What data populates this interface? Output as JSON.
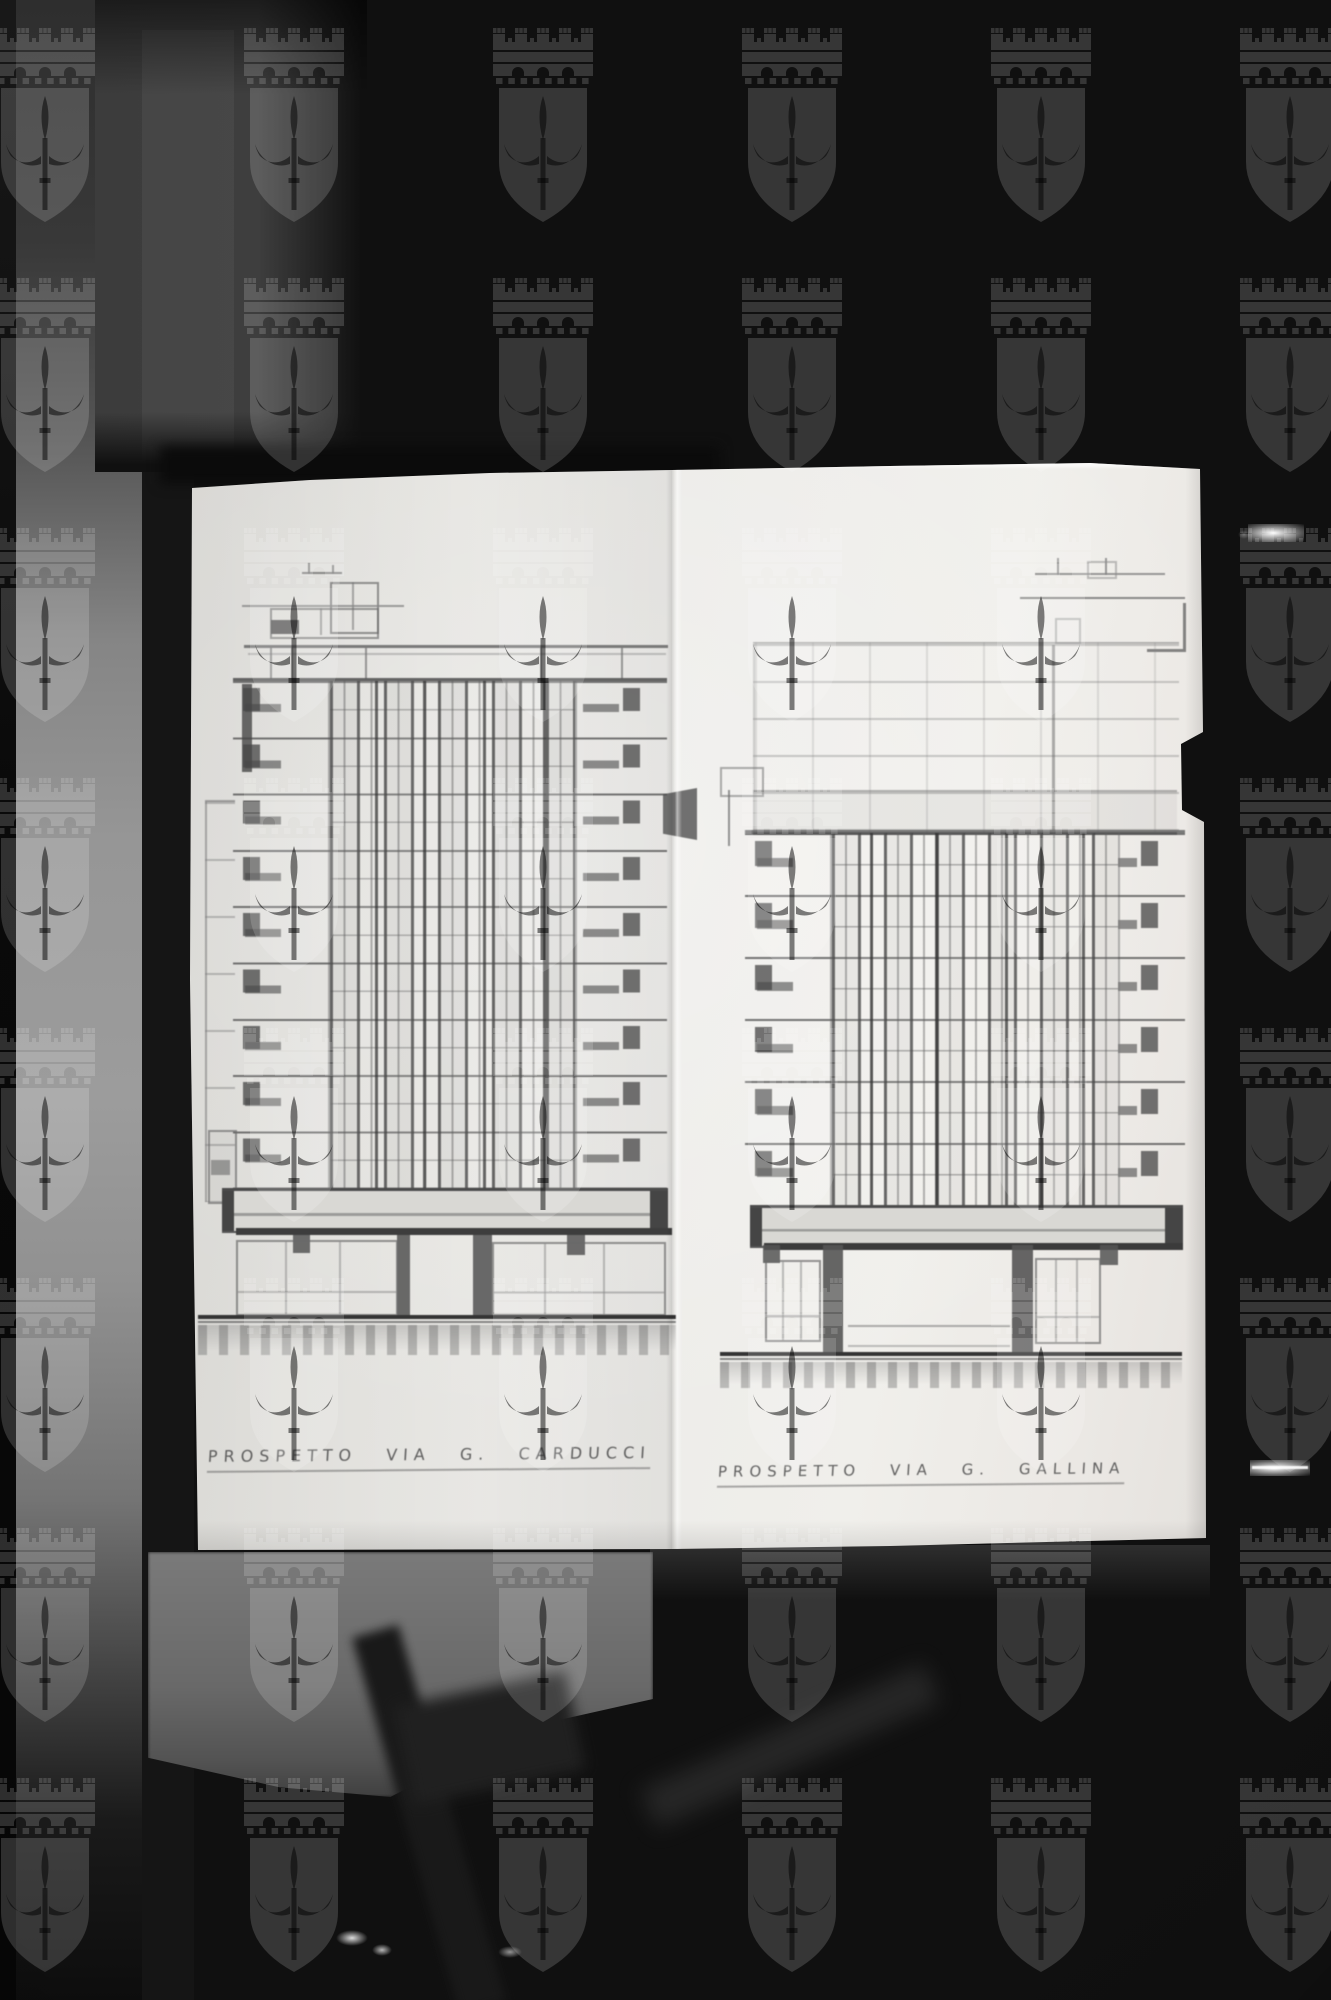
{
  "captions": {
    "left": "PROSPETTO VIA G. CARDUCCI",
    "right": "PROSPETTO VIA G. GALLINA"
  },
  "watermark": {
    "icon": "trieste-coat-of-arms-crest",
    "columns": 6,
    "rows": 8,
    "pitch_x": 249,
    "pitch_y": 250,
    "origin_x": 45,
    "origin_y": 28,
    "color": "#ffffff",
    "opacity": 0.16
  },
  "colors": {
    "background": "#101010",
    "paper": "#edece9",
    "pencil": "#555555",
    "highlight_streak": "#ffffff"
  }
}
